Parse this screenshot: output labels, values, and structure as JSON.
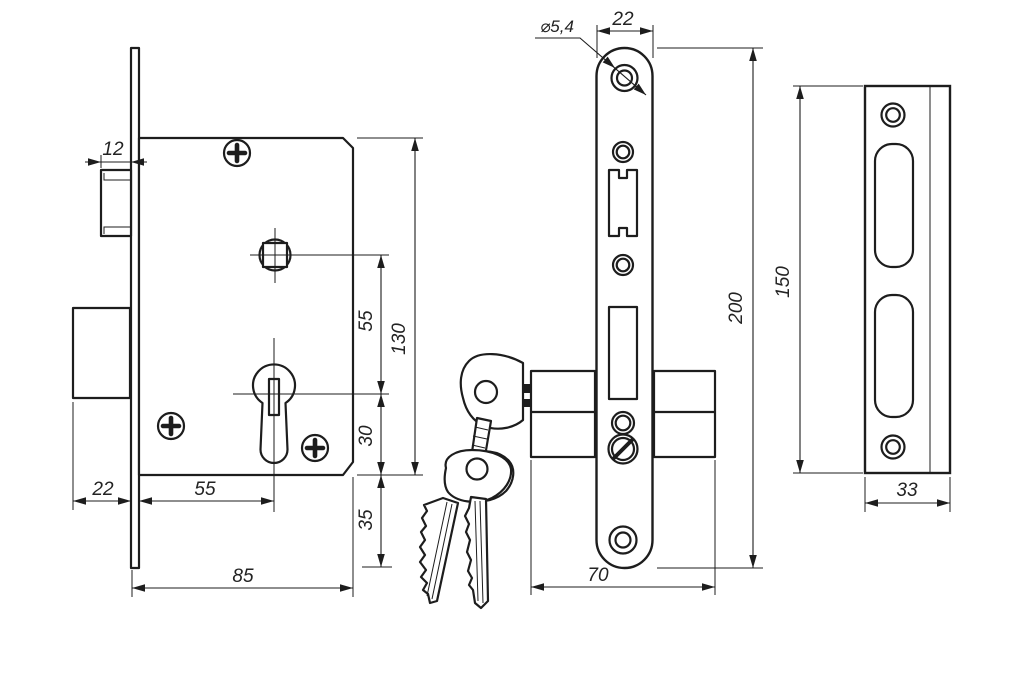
{
  "meta": {
    "drawing_type": "mortise lock technical drawing",
    "background": "#ffffff",
    "line_color": "#1d1d1d"
  },
  "side_view": {
    "name": "lock body side view",
    "dims": {
      "latch_width": "12",
      "spindle_to_cylinder": "55",
      "body_height": "130",
      "cylinder_to_edge": "30",
      "edge_to_plate_end": "35",
      "bolt_throw": "22",
      "backset": "55",
      "body_depth": "85"
    }
  },
  "front_view": {
    "name": "faceplate front view with keys",
    "dims": {
      "hole_diameter": "⌀5,4",
      "plate_width": "22",
      "plate_length": "200",
      "cylinder_length": "70"
    }
  },
  "strike_view": {
    "name": "strike plate view",
    "dims": {
      "plate_length": "150",
      "plate_width": "33"
    }
  }
}
